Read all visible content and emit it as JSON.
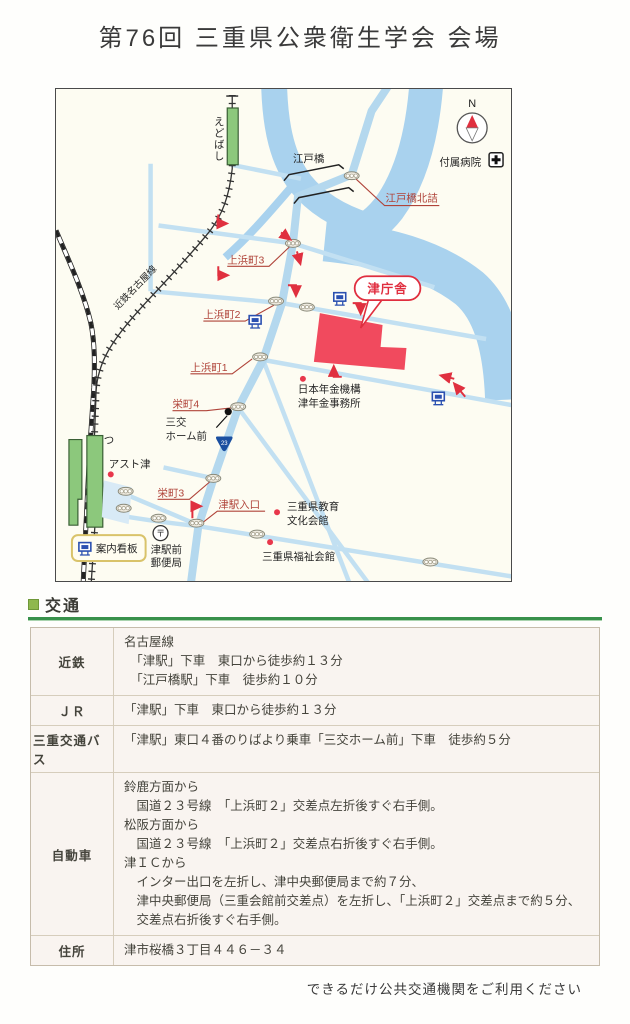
{
  "page": {
    "title": "第76回 三重県公衆衛生学会 会場",
    "footer_note": "できるだけ公共交通機関をご利用ください"
  },
  "map": {
    "compass_label": "N",
    "labels": {
      "edobashi_station": "えどばし",
      "edobashi_bridge": "江戸橋",
      "edobashi_kitazume": "江戸橋北詰",
      "fuzoku_hospital": "付属病院",
      "kintetsu_nagoya_line": "近鉄名古屋線",
      "kamihama3": "上浜町3",
      "kamihama2": "上浜町2",
      "kamihama1": "上浜町1",
      "tsu_chosha": "津庁舎",
      "nenkin_line1": "日本年金機構",
      "nenkin_line2": "津年金事務所",
      "sakaemachi4": "栄町4",
      "sanko_line1": "三交",
      "sanko_line2": "ホーム前",
      "route23": "23",
      "tsu_station_kana": "つ",
      "ast_tsu": "アスト津",
      "sakaemachi3": "栄町3",
      "tsueki_iriguchi": "津駅入口",
      "annai_kanban": "案内看板",
      "post_mark": "〒",
      "post_office_line1": "津駅前",
      "post_office_line2": "郵便局",
      "kyoiku_line1": "三重県教育",
      "kyoiku_line2": "文化会館",
      "fukushi_kaikan": "三重県福祉会館"
    },
    "colors": {
      "river": "#a9d2ee",
      "road": "#c2e0f2",
      "main_road": "#b4d8ee",
      "station_green": "#8cc87c",
      "venue_red": "#f14a5e",
      "label_red": "#b0443a",
      "accent_red": "#e0303f",
      "sign_blue": "#2b50b0"
    }
  },
  "transport": {
    "heading": "交通",
    "rows": [
      {
        "header": "近鉄",
        "lines": [
          "名古屋線",
          "　「津駅」下車　東口から徒歩約１３分",
          "　「江戸橋駅」下車　徒歩約１０分"
        ]
      },
      {
        "header": "ＪＲ",
        "lines": [
          "「津駅」下車　東口から徒歩約１３分"
        ]
      },
      {
        "header": "三重交通バス",
        "lines": [
          "「津駅」東口４番のりばより乗車「三交ホーム前」下車　徒歩約５分"
        ]
      },
      {
        "header": "自動車",
        "lines": [
          "鈴鹿方面から",
          "　国道２３号線　「上浜町２」交差点左折後すぐ右手側。",
          "松阪方面から",
          "　国道２３号線　「上浜町２」交差点右折後すぐ右手側。",
          "津ＩＣから",
          "　インター出口を左折し、津中央郵便局まで約７分、",
          "　津中央郵便局（三重会館前交差点）を左折し、「上浜町２」交差点まで約５分、",
          "　交差点右折後すぐ右手側。"
        ]
      },
      {
        "header": "住所",
        "lines": [
          "津市桜橋３丁目４４６－３４"
        ]
      }
    ]
  }
}
